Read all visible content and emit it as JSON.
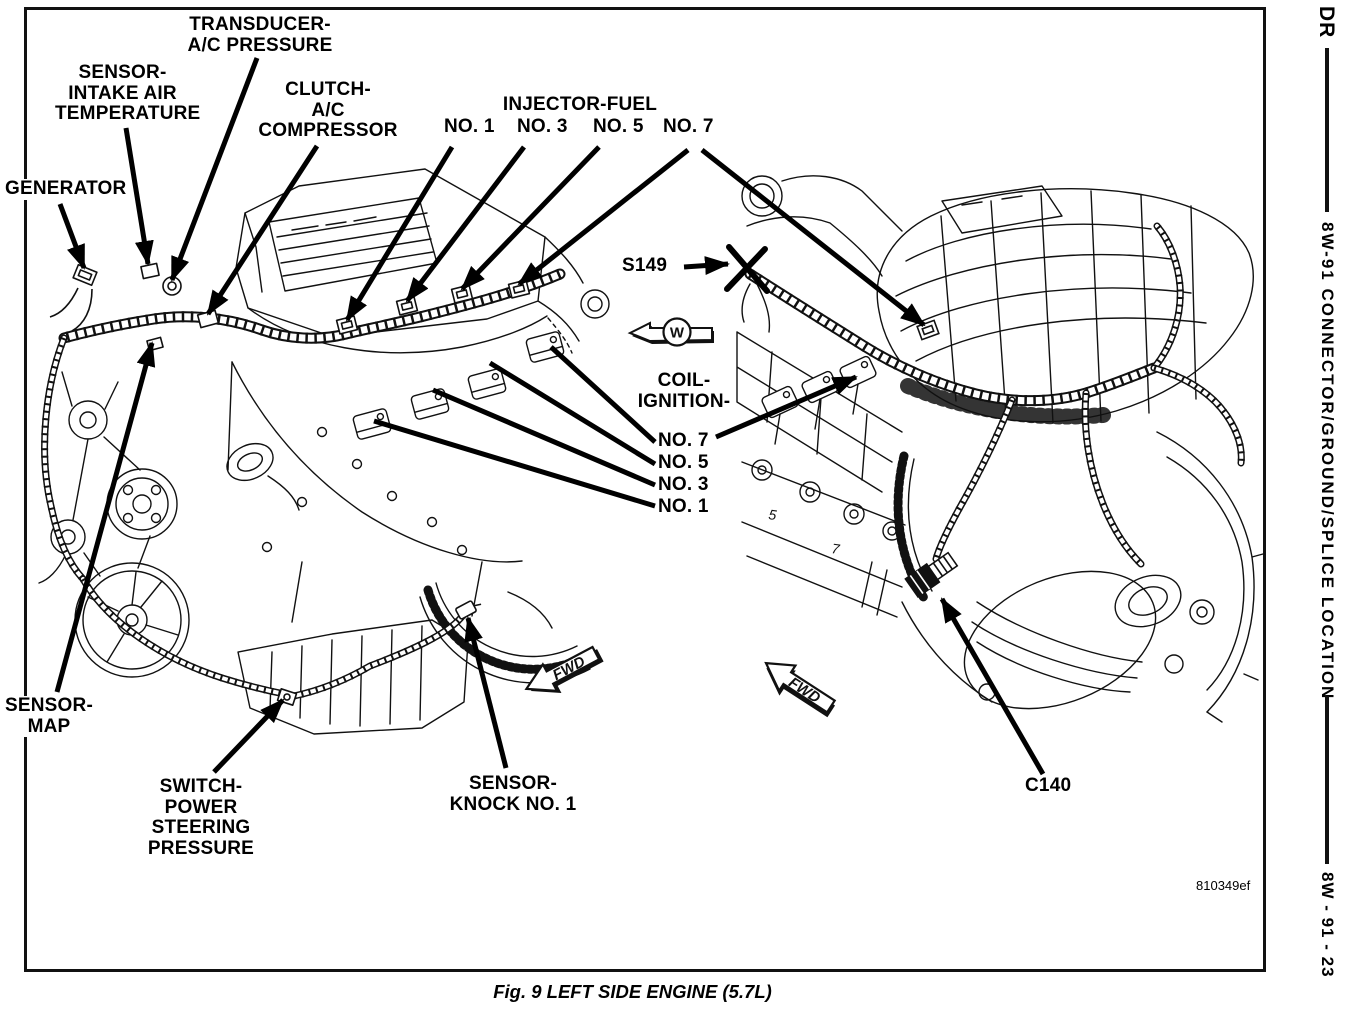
{
  "page": {
    "caption": "Fig. 9 LEFT SIDE ENGINE (5.7L)",
    "image_ref": "810349ef"
  },
  "sidebar": {
    "model_code": "DR",
    "section_title": "8W-91 CONNECTOR/GROUND/SPLICE LOCATION",
    "page_ref": "8W - 91 - 23"
  },
  "symbols": {
    "direction_letter": "W",
    "fwd_label": "FWD",
    "cylinder_mark_5": "5",
    "cylinder_mark_7": "7"
  },
  "callouts": {
    "generator": "GENERATOR",
    "sensor_intake_air_temperature": "SENSOR-\nINTAKE AIR\nTEMPERATURE",
    "transducer_ac_pressure": "TRANSDUCER-\nA/C PRESSURE",
    "clutch_ac_compressor": "CLUTCH-\nA/C\nCOMPRESSOR",
    "injector_fuel": "INJECTOR-FUEL",
    "injector_no_1": "NO. 1",
    "injector_no_3": "NO. 3",
    "injector_no_5": "NO. 5",
    "injector_no_7": "NO. 7",
    "splice_s149": "S149",
    "coil_ignition": "COIL-\nIGNITION-",
    "coil_no_7": "NO. 7",
    "coil_no_5": "NO. 5",
    "coil_no_3": "NO. 3",
    "coil_no_1": "NO. 1",
    "sensor_map": "SENSOR-\nMAP",
    "switch_power_steering_pressure": "SWITCH-\nPOWER\nSTEERING\nPRESSURE",
    "sensor_knock_no_1": "SENSOR-\nKNOCK NO. 1",
    "connector_c140": "C140"
  },
  "colors": {
    "ink": "#000000",
    "paper": "#ffffff"
  }
}
